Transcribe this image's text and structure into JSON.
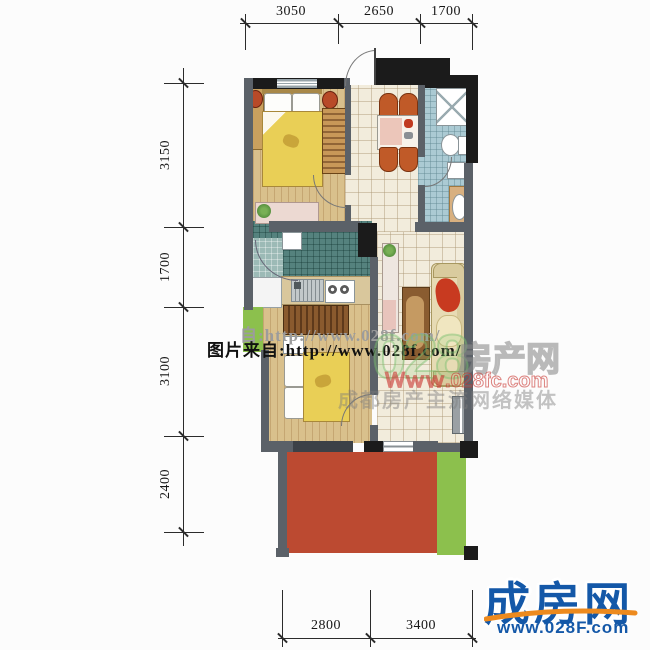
{
  "dimensions": {
    "top": [
      "3050",
      "2650",
      "1700"
    ],
    "left": [
      "3150",
      "1700",
      "3100",
      "2400"
    ],
    "bottom": [
      "2800",
      "3400"
    ]
  },
  "watermarks": {
    "photo_credit_shadow": "自:http://www.028f.com/",
    "photo_credit": "图片来自:http://www.028f.com/",
    "big_number": "028",
    "site_name_outline": "房产网",
    "site_url_red": "Ｗｗｗ.028fc.com",
    "tagline": "成都房产主流网络媒体"
  },
  "logo": {
    "brand": "成房网",
    "url": "www.028F.com"
  },
  "colors": {
    "terrace_red": "#bc4a31",
    "lawn_green": "#8cc04d",
    "bed_yellow": "#e9cf56",
    "kitchen_teal": "#55827e",
    "bath_blue": "#abcad3",
    "tile_cream": "#f2ecdc",
    "wood": "#d9c08c",
    "wall_gray": "#5b6168",
    "wall_black": "#1b1b1b",
    "logo_blue": "#1458a8",
    "logo_orange": "#ed8a1e"
  }
}
